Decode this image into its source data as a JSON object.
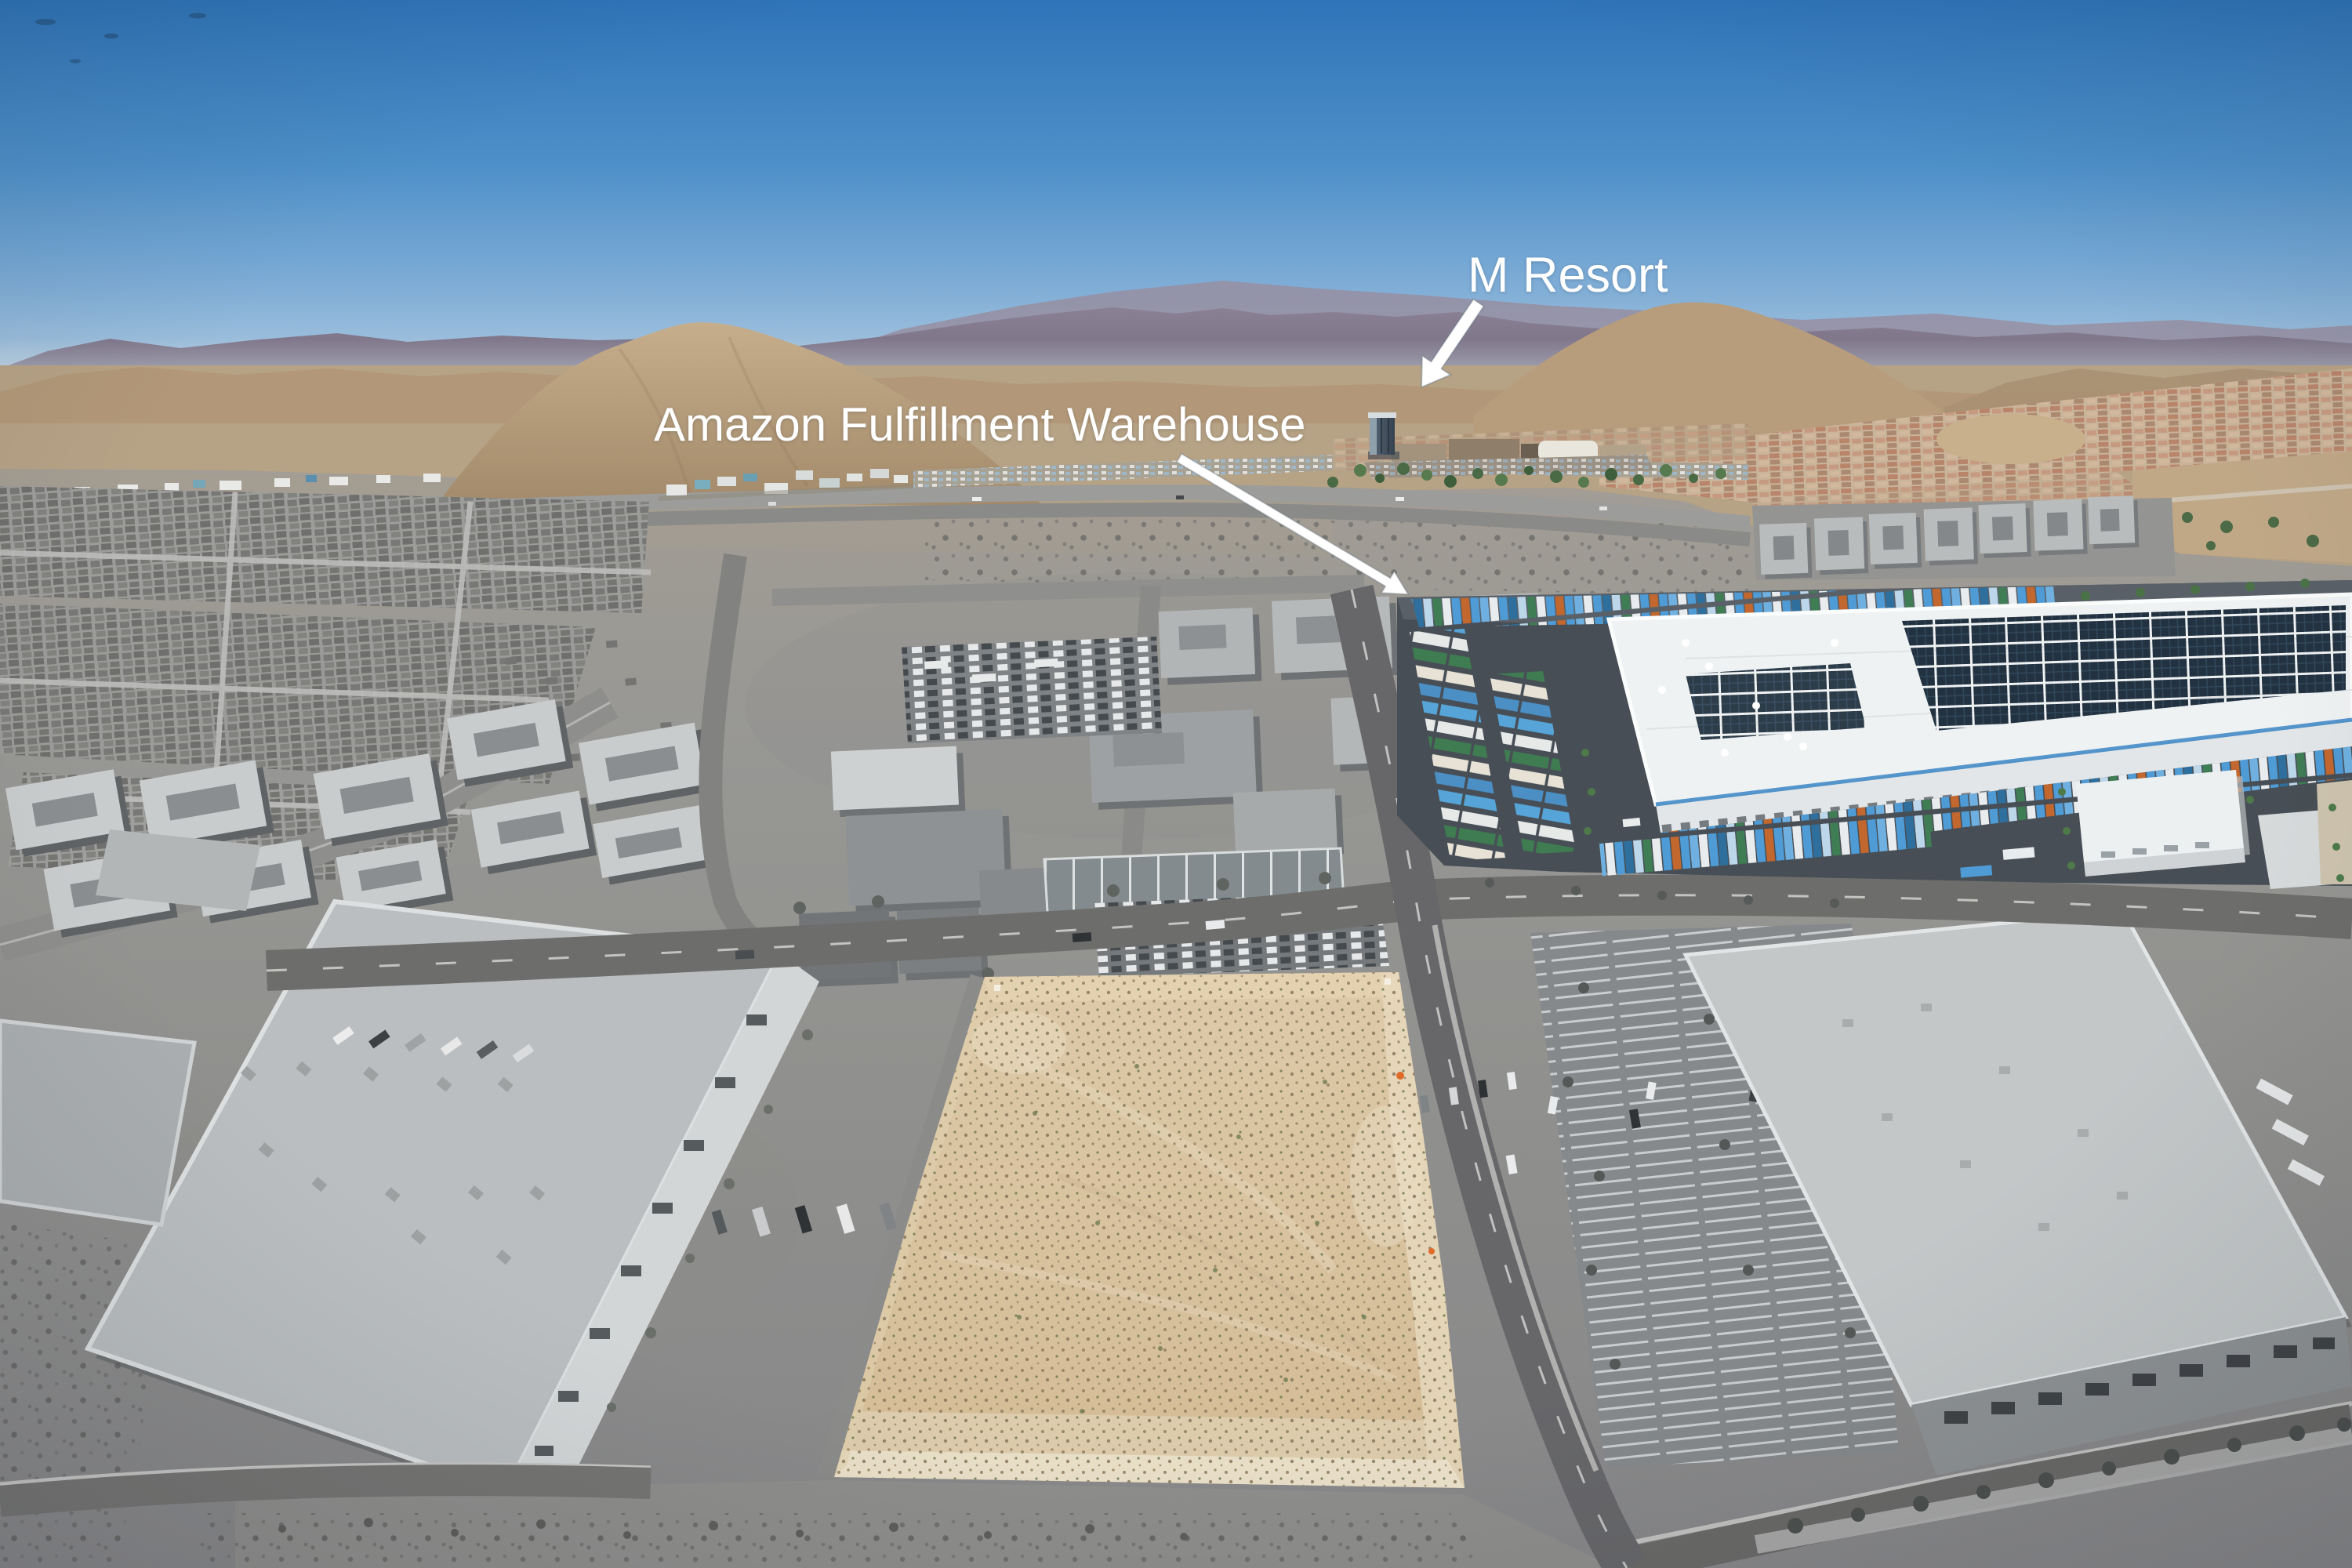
{
  "annotations": {
    "amazon": {
      "label": "Amazon Fulfillment Warehouse"
    },
    "m_resort": {
      "label": "M Resort"
    }
  },
  "colors": {
    "sky_top": "#2f74b8",
    "sky_horizon": "#a9c6de",
    "annotation_text": "#ffffff",
    "annotation_arrow": "#ffffff",
    "parcel_sand": "#d8c09c",
    "amazon_roof_white": "#eff2f3",
    "amazon_parapet_blue": "#4aa0d8",
    "trailer_blue": "#4f9bd6",
    "asphalt_dark": "#474e55",
    "grayscale_ground": "#939391",
    "mountain_purple": "#7d7486",
    "foothill_tan": "#b39977"
  }
}
